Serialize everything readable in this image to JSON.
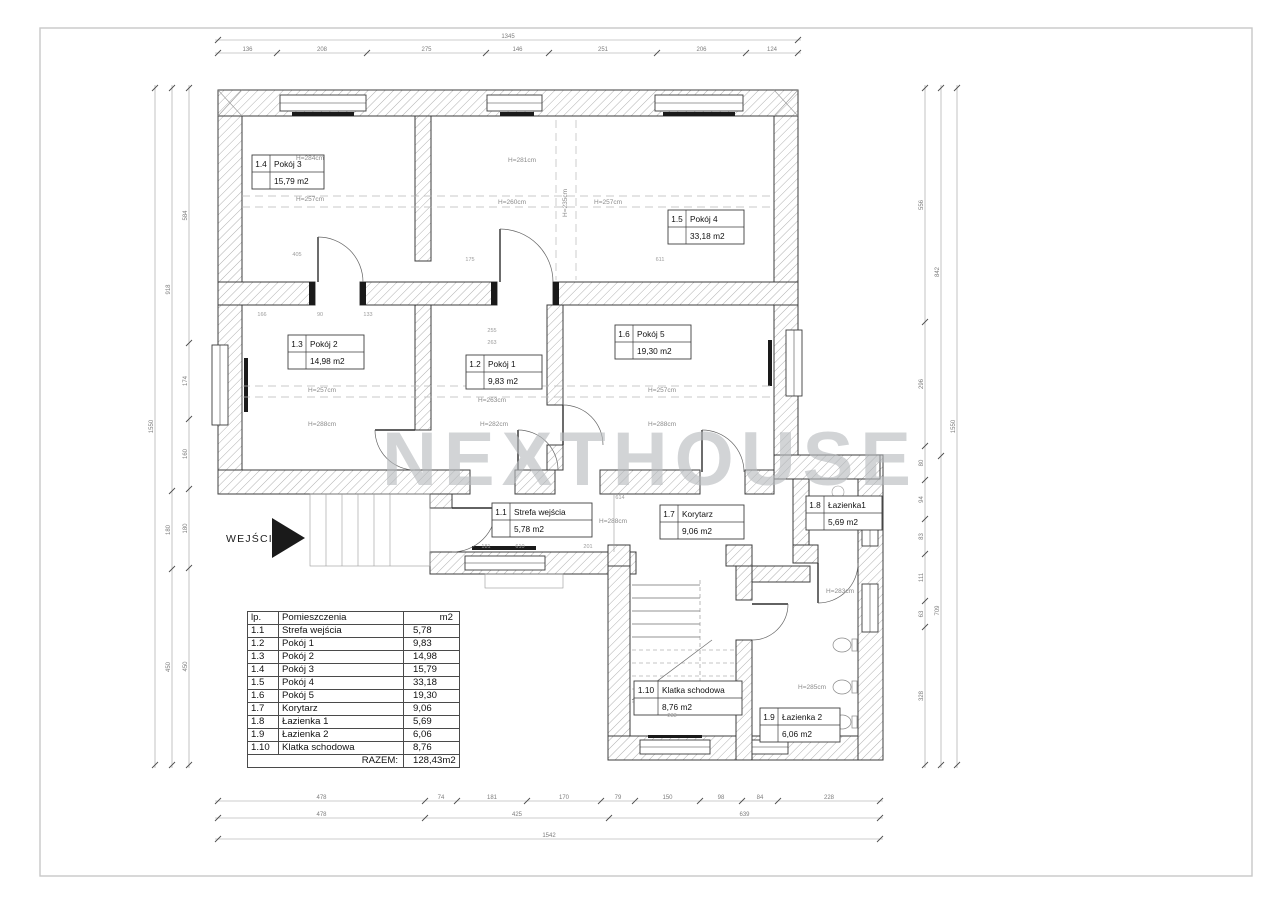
{
  "watermark": "NEXTHOUSE",
  "entrance": {
    "label": "WEJŚCIE"
  },
  "rooms": [
    {
      "num": "1.1",
      "name": "Strefa wejścia",
      "area": "5,78 m2"
    },
    {
      "num": "1.2",
      "name": "Pokój 1",
      "area": "9,83 m2"
    },
    {
      "num": "1.3",
      "name": "Pokój 2",
      "area": "14,98 m2"
    },
    {
      "num": "1.4",
      "name": "Pokój 3",
      "area": "15,79 m2"
    },
    {
      "num": "1.5",
      "name": "Pokój 4",
      "area": "33,18 m2"
    },
    {
      "num": "1.6",
      "name": "Pokój 5",
      "area": "19,30 m2"
    },
    {
      "num": "1.7",
      "name": "Korytarz",
      "area": "9,06 m2"
    },
    {
      "num": "1.8",
      "name": "Łazienka1",
      "area": "5,69 m2"
    },
    {
      "num": "1.9",
      "name": "Łazienka 2",
      "area": "6,06 m2"
    },
    {
      "num": "1.10",
      "name": "Klatka schodowa",
      "area": "8,76 m2"
    }
  ],
  "heights": {
    "p3a": "H=284cm",
    "p3b": "H=257cm",
    "p4a": "H=281cm",
    "p4b": "H=260cm",
    "p4c": "H=235cm",
    "p4d": "H=257cm",
    "p2a": "H=257cm",
    "p2b": "H=288cm",
    "p1a": "H=263cm",
    "p1b": "H=282cm",
    "p5a": "H=257cm",
    "p5b": "H=288cm",
    "sw": "H=288cm",
    "l1": "H=283cm",
    "l2": "H=285cm"
  },
  "table": {
    "headers": {
      "lp": "lp.",
      "name": "Pomieszczenia",
      "area": "m2"
    },
    "rows": [
      {
        "lp": "1.1",
        "name": "Strefa wejścia",
        "area": "5,78"
      },
      {
        "lp": "1.2",
        "name": "Pokój 1",
        "area": "9,83"
      },
      {
        "lp": "1.3",
        "name": "Pokój 2",
        "area": "14,98"
      },
      {
        "lp": "1.4",
        "name": "Pokój 3",
        "area": "15,79"
      },
      {
        "lp": "1.5",
        "name": "Pokój 4",
        "area": "33,18"
      },
      {
        "lp": "1.6",
        "name": "Pokój 5",
        "area": "19,30"
      },
      {
        "lp": "1.7",
        "name": "Korytarz",
        "area": "9,06"
      },
      {
        "lp": "1.8",
        "name": "Łazienka 1",
        "area": "5,69"
      },
      {
        "lp": "1.9",
        "name": "Łazienka 2",
        "area": "6,06"
      },
      {
        "lp": "1.10",
        "name": "Klatka schodowa",
        "area": "8,76"
      }
    ],
    "total_label": "RAZEM:",
    "total_value": "128,43m2"
  },
  "dims": {
    "top_total": [
      "1345"
    ],
    "top_seg": [
      "136",
      "208",
      "275",
      "146",
      "251",
      "206",
      "124"
    ],
    "bottom_r1": [
      "478",
      "74",
      "181",
      "170",
      "79",
      "150",
      "98",
      "84",
      "228"
    ],
    "bottom_r2": [
      "478",
      "425",
      "639"
    ],
    "bottom_total": [
      "1542"
    ],
    "left_inner": [
      "584",
      "174",
      "160",
      "180",
      "450"
    ],
    "left_mid": [
      "918",
      "180",
      "450"
    ],
    "left_total": [
      "1550"
    ],
    "right_inner": [
      "556",
      "296",
      "80",
      "94",
      "83",
      "111",
      "63",
      "328"
    ],
    "right_mid": [
      "842",
      "709"
    ],
    "right_total": [
      "1550"
    ]
  },
  "interior": [
    "405",
    "166",
    "90",
    "133",
    "255",
    "263",
    "175",
    "611",
    "614",
    "610",
    "201",
    "233",
    "181"
  ]
}
